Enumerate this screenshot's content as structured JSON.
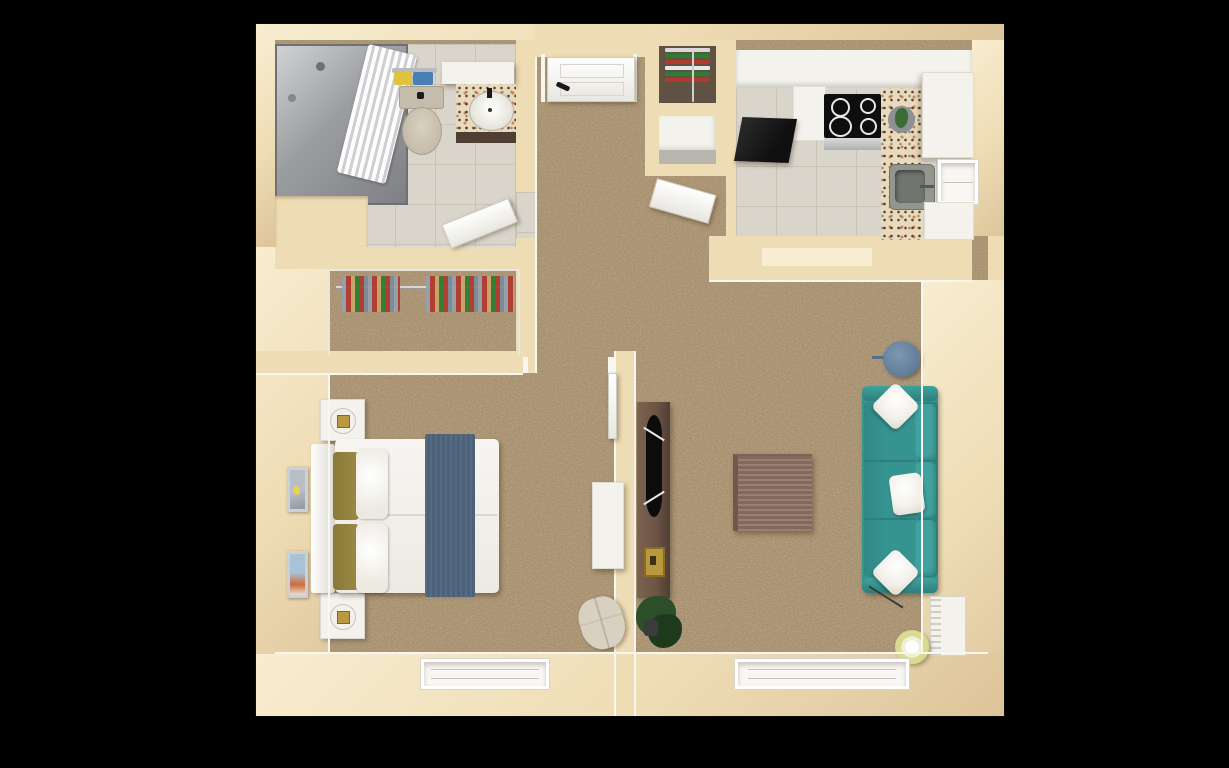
{
  "scene": {
    "description": "3D top-down rendered floor plan of a one-bedroom apartment on a black background",
    "background": "#000000",
    "visible_text": "none"
  },
  "colors": {
    "wall": "#eedcb4",
    "wall-light": "#f8edd0",
    "wall-shade": "#ddc49a",
    "carpet": "#ab9371",
    "carpet-dark": "#54402c",
    "carpet-light": "#e3d2ae",
    "tile": "#d9d5ca",
    "tile-line": "#c8c3b6",
    "granite": "#e9d9bd",
    "white": "#f4f2ec",
    "teal": "#359390",
    "teal-dark": "#2d7f7c",
    "teal-light": "#41a29d",
    "steel-blue": "#64809c",
    "runner-blue": "#4c627a",
    "olive": "#9c8a45",
    "wood-brown": "#8d7264",
    "walnut": "#6b5444",
    "walnut-dark": "#4e3e33",
    "black": "#141414",
    "gray-sink": "#93968f",
    "brass": "#b9983f",
    "plant": "#2c4f2a",
    "lamp-yellow": "#d8da8e",
    "chair-beige": "#d8d1c2",
    "art-blue": "#a9c3d6",
    "art-orange": "#d0693a",
    "art-gray": "#b9bec6",
    "art-yellow": "#e8d44c",
    "towel-yellow": "#dfc23e",
    "towel-blue": "#4a7fb5",
    "cloth-red": "#b03a2e",
    "cloth-green": "#2e7d32",
    "cloth-tan": "#c8a46a",
    "cloth-gray": "#95a0ab",
    "cloth-blue": "#7d8a99",
    "toilet": "#c6bcab",
    "glass": "#a7a9ac"
  },
  "rooms": {
    "bathroom": {
      "items": [
        "glass shower with white curtain and shower head",
        "toilet",
        "towel rack with yellow and blue towels",
        "granite vanity with white oval sink and mirror",
        "open white door"
      ]
    },
    "entry": {
      "items": [
        "white front door with black handle",
        "carpeted hallway"
      ]
    },
    "storage": {
      "items": [
        "linen shelves with green red and white towels",
        "white shelf niche",
        "open white door",
        "closet with hanging clothes on rod"
      ]
    },
    "kitchen": {
      "items": [
        "white upper cabinets",
        "black refrigerator",
        "black cooktop with four burners",
        "granite countertop",
        "gray sink",
        "window",
        "potted plant on counter",
        "white base cabinets",
        "gray tile floor"
      ]
    },
    "bedroom": {
      "items": [
        "double bed with white duvet, olive pillows and blue runner",
        "two white nightstands with lamps",
        "two framed artworks",
        "white desk",
        "beige chair",
        "window",
        "white door leaf"
      ]
    },
    "living_room": {
      "items": [
        "teal sofa with three white pillows",
        "square wood coffee table",
        "dark wood media console with TV",
        "brass box",
        "round steel-blue side table",
        "yellow drum floor lamp",
        "potted plant",
        "white radiator",
        "window"
      ]
    }
  }
}
